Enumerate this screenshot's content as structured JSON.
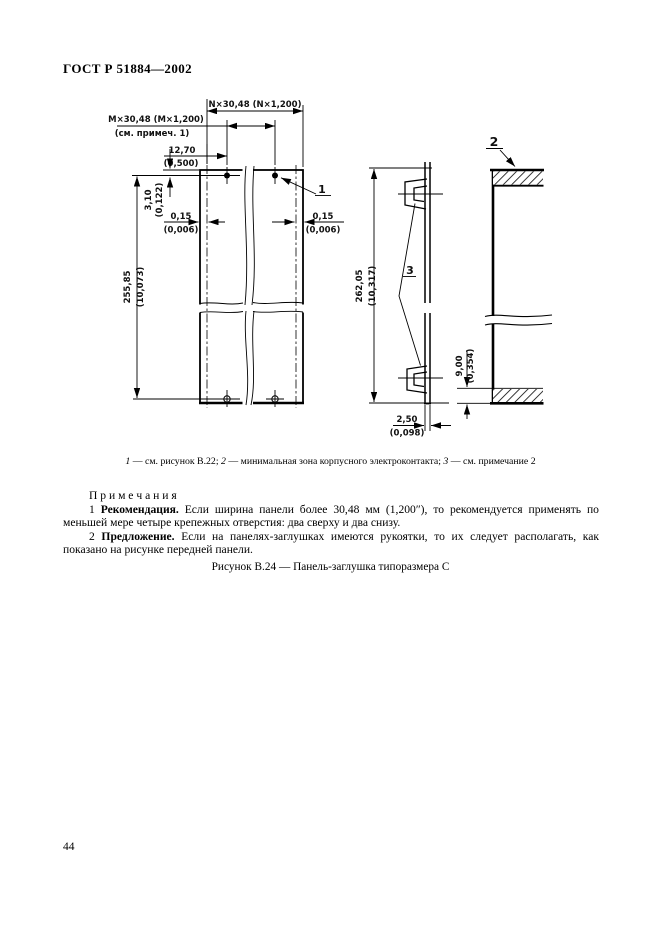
{
  "page": {
    "header": "ГОСТ Р 51884—2002",
    "page_number": "44"
  },
  "drawing": {
    "callouts": {
      "c1": "1",
      "c2": "2",
      "c3": "3"
    },
    "dims": {
      "n_label": "N×30,48 (N×1,200)",
      "m_label": "M×30,48 (M×1,200)",
      "m_note": "(см. примеч. 1)",
      "w1270": "12,70",
      "w1270_in": "(0,500)",
      "h310": "3,10",
      "h310_in": "(0,122)",
      "g015_l": "0,15",
      "g015_l_in": "(0,006)",
      "g015_r": "0,15",
      "g015_r_in": "(0,006)",
      "h25585": "255,85",
      "h25585_in": "(10,073)",
      "h26205": "262,05",
      "h26205_in": "(10,317)",
      "h900": "9,00",
      "h900_in": "(0,354)",
      "t250": "2,50",
      "t250_in": "(0,098)"
    }
  },
  "caption": {
    "items": [
      {
        "num": "1",
        "text": "— см. рисунок В.22;"
      },
      {
        "num": "2",
        "text": "— минимальная зона корпусного электроконтакта;"
      },
      {
        "num": "3",
        "text": "— см. примечание 2"
      }
    ]
  },
  "notes": {
    "heading": "П р и м е ч а н и я",
    "items": [
      {
        "num": "1",
        "term": "Рекомендация.",
        "text": "Если ширина панели более 30,48 мм (1,200″), то рекомендуется применять по меньшей мере четыре крепежных отверстия: два сверху и два снизу."
      },
      {
        "num": "2",
        "term": "Предложение.",
        "text": "Если на панелях-заглушках имеются рукоятки, то их следует располагать, как показано на рисунке передней панели."
      }
    ]
  },
  "figure_title": "Рисунок В.24 — Панель-заглушка типоразмера С"
}
